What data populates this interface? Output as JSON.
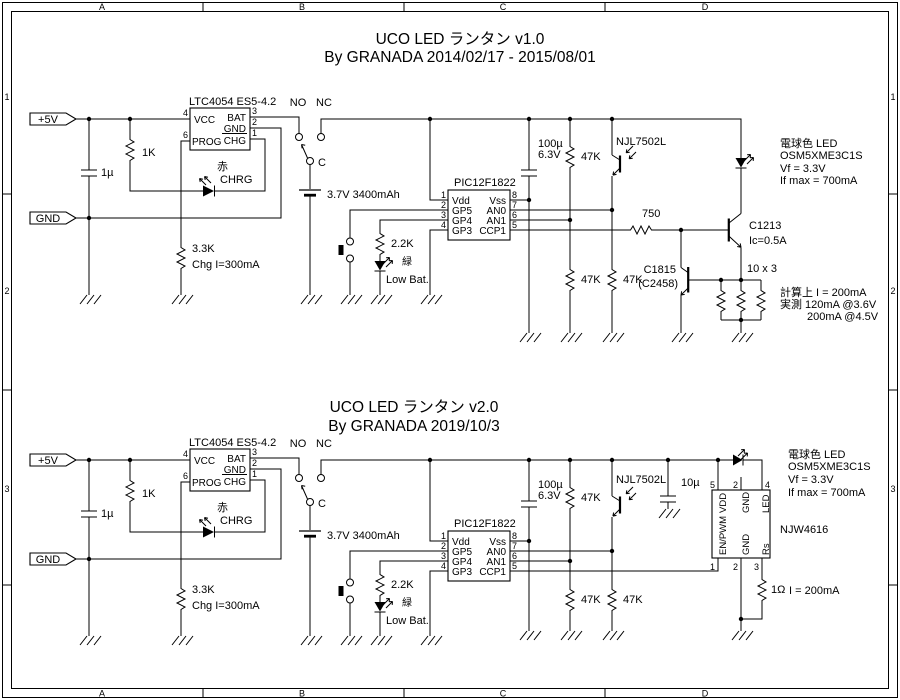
{
  "frame": {
    "columns": [
      "A",
      "B",
      "C",
      "D"
    ],
    "rows": [
      "1",
      "2",
      "3"
    ]
  },
  "titles": {
    "v1_title": "UCO LED ランタン v1.0",
    "v1_byline": "By GRANADA 2014/02/17 - 2015/08/01",
    "v2_title": "UCO LED ランタン v2.0",
    "v2_byline": "By GRANADA 2019/10/3"
  },
  "power": {
    "vcc": "+5V",
    "gnd": "GND"
  },
  "charger": {
    "ic": "LTC4054 ES5-4.2",
    "pin_vcc": "VCC",
    "pin_bat": "BAT",
    "pin_gnd": "GND",
    "pin_prog": "PROG",
    "pin_chg": "CHG",
    "num_vcc": "4",
    "num_prog": "6",
    "num_bat": "3",
    "num_gnd": "2",
    "num_chg": "1",
    "cap_in": "1µ",
    "r_pullup": "1K",
    "led_color": "赤",
    "led_name": "CHRG",
    "r_prog": "3.3K",
    "prog_note": "Chg I=300mA"
  },
  "switch": {
    "no": "NO",
    "nc": "NC",
    "common": "C"
  },
  "battery": {
    "label": "3.7V 3400mAh"
  },
  "lowbat": {
    "resistor": "2.2K",
    "led_color": "緑",
    "label": "Low Bat."
  },
  "mcu": {
    "name": "PIC12F1822",
    "pins_left": [
      "Vdd",
      "GP5",
      "GP4",
      "GP3"
    ],
    "pins_right": [
      "Vss",
      "AN0",
      "AN1",
      "CCP1"
    ],
    "nums_left": [
      "1",
      "2",
      "3",
      "4"
    ],
    "nums_right": [
      "8",
      "7",
      "6",
      "5"
    ]
  },
  "sense": {
    "cap": "100µ",
    "cap_v": "6.3V",
    "r_div": "47K",
    "photo": "NJL7502L"
  },
  "out_led": {
    "line1": "電球色 LED",
    "line2": "OSM5XME3C1S",
    "line3": "Vf = 3.3V",
    "line4": "If max = 700mA"
  },
  "v1": {
    "r_base": "750",
    "q_out": "C1213",
    "q_out_note": "Ic=0.5A",
    "q_limit": "C1815",
    "q_limit_alt": "(C2458)",
    "r_sense": "10 x 3",
    "note1": "計算上 I = 200mA",
    "note2": "実測 120mA @3.6V",
    "note3": "200mA @4.5V"
  },
  "v2": {
    "cap": "10µ",
    "driver": "NJW4616",
    "p_vdd": "VDD",
    "p_gnd": "GND",
    "p_led": "LED",
    "p_en": "EN/PWM",
    "p_rs": "Rs",
    "n5": "5",
    "n2": "2",
    "n4": "4",
    "n1": "1",
    "n3": "3",
    "r_sense": "1Ω",
    "note": "I = 200mA"
  }
}
